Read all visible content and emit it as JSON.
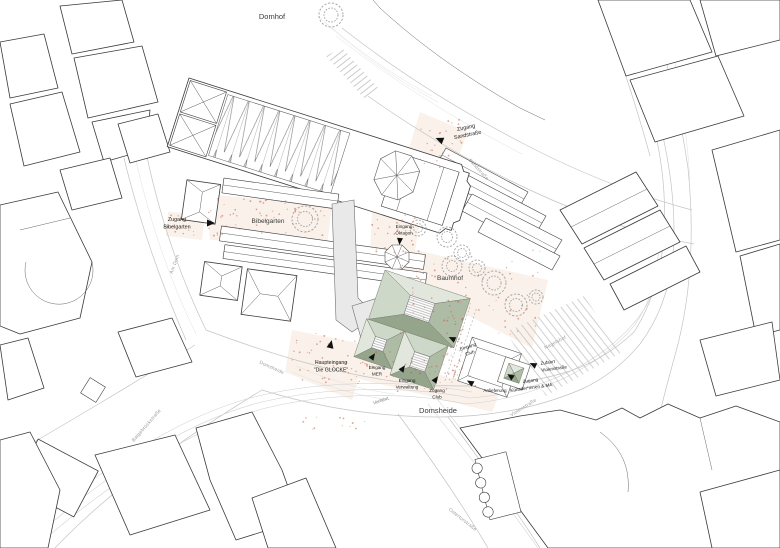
{
  "colors": {
    "building_outline": "#3a3a3a",
    "street_line": "#c4c4c4",
    "gray_building": "#e9e9e9",
    "plaza_tint": "#faf1ea",
    "roof_light": "#e2e7dd",
    "roof_pale": "#ced8c8",
    "roof_mid": "#aebba5",
    "roof_dark": "#94a58c",
    "speckle": "#c0614a"
  },
  "areas": {
    "domhof": "Domhof",
    "bibelgarten": "Bibelgarten",
    "baumhof": "Baumhof",
    "domsheide": "Domsheide"
  },
  "entrances": {
    "zugang_sandstrasse": {
      "line1": "Zugang",
      "line2": "Sandstraße"
    },
    "zugang_bibelgarten": {
      "line1": "Zugang",
      "line2": "Bibelgarten"
    },
    "eingang_oktagon": {
      "line1": "Eingang",
      "line2": "Oktagon"
    },
    "haupteingang": {
      "line1": "Haupteingang",
      "line2": "\"Die GLOCKE\""
    },
    "eingang_mer": {
      "line1": "Eingang",
      "line2": "MER"
    },
    "eingang_verwaltung": {
      "line1": "Eingang",
      "line2": "Verwaltung"
    },
    "zugang_club": {
      "line1": "Zugang",
      "line2": "Club"
    },
    "eingang_club": {
      "line1": "Eingang",
      "line2": "Club"
    },
    "anlieferung": {
      "line1": "Anlieferung"
    },
    "zufahrt_violenstrasse": {
      "line1": "Zufahrt",
      "line2": "Violenstraße"
    },
    "zugang_kuenstler": {
      "line1": "Zugang",
      "line2": "Künstler*innen & MA"
    },
    "vorfahrt": {
      "line1": "Vorfahrt"
    }
  },
  "streets": {
    "am_dom": "Am Dom",
    "sandstrasse": "Sandstraße",
    "domsheide": "Domsheide",
    "balgebrueckstrasse": "Balgebrückstraße",
    "violenstrasse": "Violenstraße",
    "ostertorstrasse": "Ostertorstraße",
    "nagelshof": "Nagelshof"
  }
}
